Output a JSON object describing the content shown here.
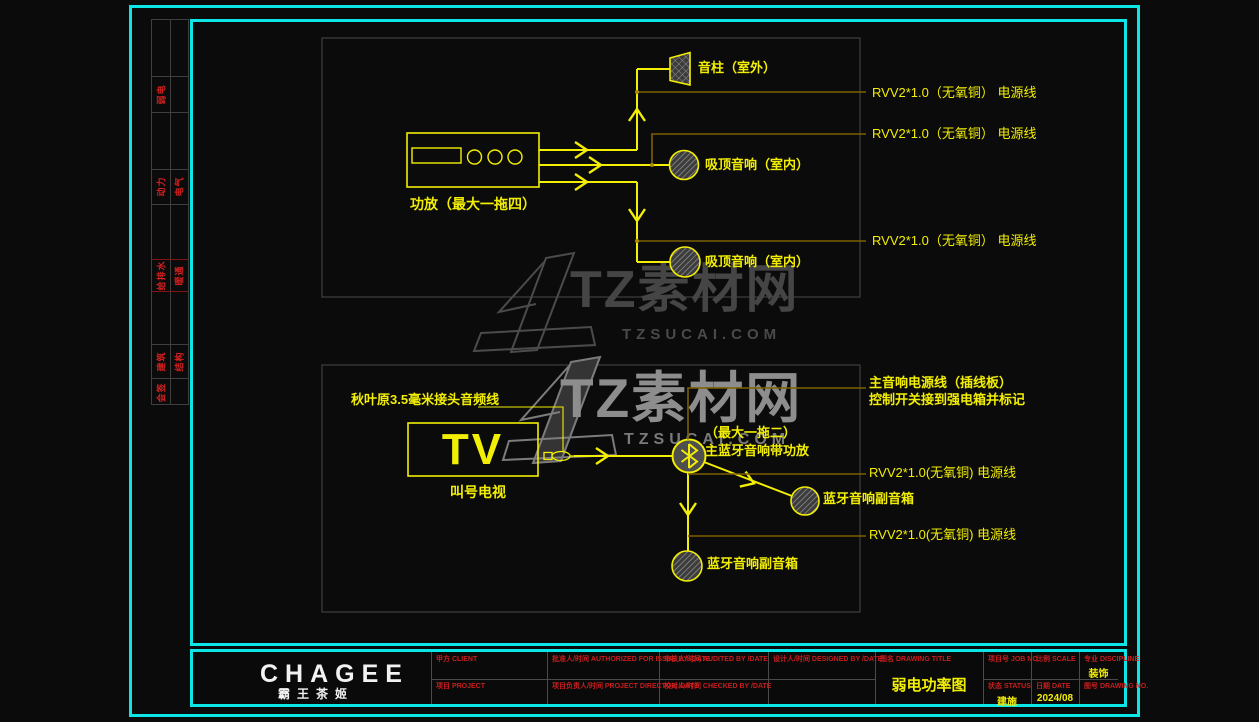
{
  "doc": {
    "type_note": "CAD weak-current power diagram sheet",
    "colors": {
      "frame_cyan": "#0ce6e6",
      "line_yellow": "#f2ee04",
      "power_line_olive": "#7d6000",
      "box_gray": "#4a4a4a",
      "label_red": "#d42020",
      "logo_white": "#f2f2f2"
    }
  },
  "signature_strip": {
    "rows": [
      {
        "left": "弱电",
        "right": ""
      },
      {
        "left": "动力",
        "right": "电气"
      },
      {
        "left": "给排水",
        "right": "暖通"
      },
      {
        "left": "建筑",
        "right": "结构"
      },
      {
        "left": "会签",
        "right": ""
      }
    ]
  },
  "top_diagram": {
    "amp_label": "功放（最大一拖四）",
    "horn_label": "音柱（室外）",
    "ceiling_label_1": "吸顶音响（室内）",
    "ceiling_label_2": "吸顶音响（室内）",
    "power_label_1": "RVV2*1.0（无氧铜） 电源线",
    "power_label_2": "RVV2*1.0（无氧铜） 电源线",
    "power_label_3": "RVV2*1.0（无氧铜） 电源线"
  },
  "bottom_diagram": {
    "cable_label": "秋叶原3.5毫米接头音频线",
    "tv_text": "TV",
    "tv_label": "叫号电视",
    "bt_capacity_label": "（最大一拖二）",
    "bt_main_label": "主蓝牙音响带功放",
    "main_power_label_line1": "主音响电源线（插线板）",
    "main_power_label_line2": "控制开关接到强电箱并标记",
    "power_label_1": "RVV2*1.0(无氧铜) 电源线",
    "power_label_2": "RVV2*1.0(无氧铜) 电源线",
    "sub_speaker_label_1": "蓝牙音响副音箱",
    "sub_speaker_label_2": "蓝牙音响副音箱"
  },
  "watermark": {
    "brand": "TZ素材网",
    "domain": "TZSUCAI.COM"
  },
  "titlebar": {
    "logo": "CHAGEE",
    "logo_cn": "霸王茶姬",
    "client_label": "甲方  CLIENT",
    "project_label": "项目  PROJECT",
    "authorized_label": "批准人/时间  AUTHORIZED FOR ISSUE BY /DATE",
    "director_label": "项目负责人/时间  PROJECT DIRECTOR /DATE",
    "audited_label": "审核人/时间  AUDITED BY /DATE",
    "checked_label": "校对人/时间  CHECKED BY /DATE",
    "designed_label": "设计人/时间  DESIGNED BY /DATE",
    "drawing_title_label": "图名  DRAWING TITLE",
    "drawing_title": "弱电功率图",
    "job_no_label": "项目号  JOB NO.",
    "status_label": "状态  STATUS",
    "status_value": "建施",
    "scale_label": "比例  SCALE",
    "date_label": "日期  DATE",
    "date_value": "2024/08",
    "discipline_label": "专业  DISCIPLINE",
    "discipline_value": "装饰",
    "drawing_no_label": "图号  DRAWING NO."
  }
}
